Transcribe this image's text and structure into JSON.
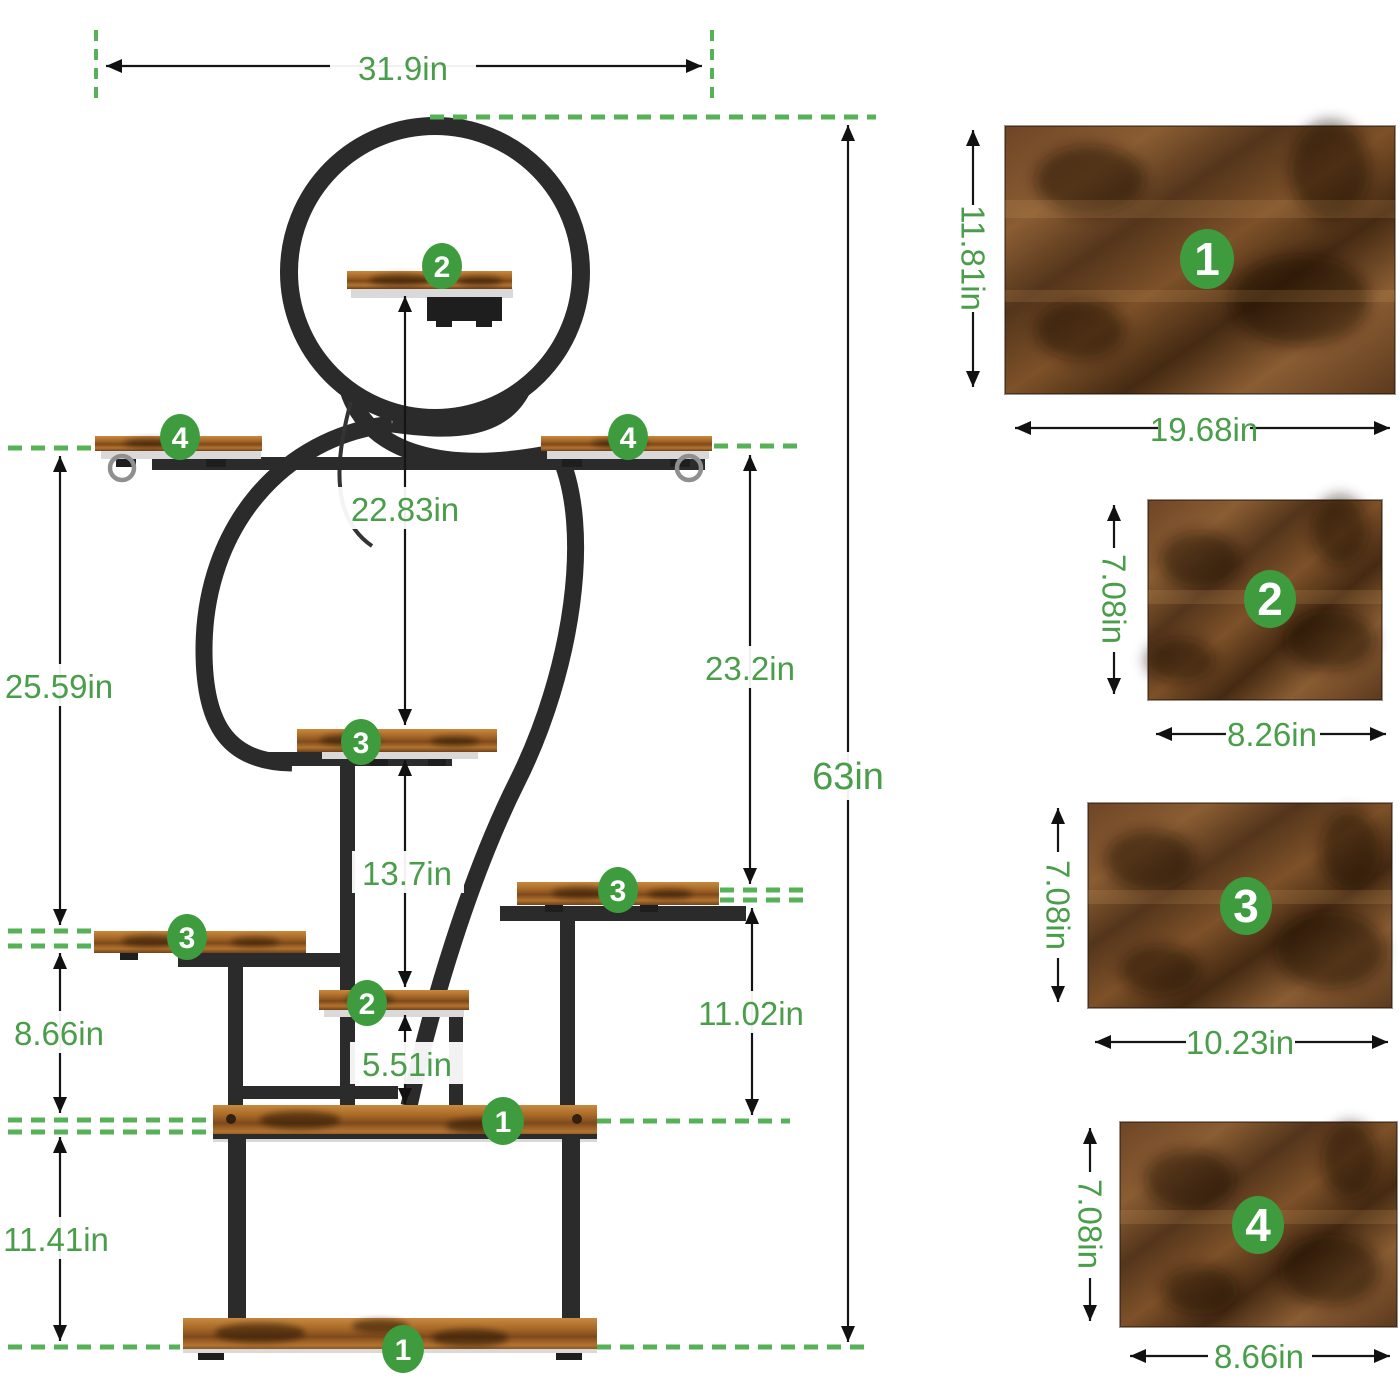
{
  "diagram": {
    "badge_labels": {
      "b1": "1",
      "b2": "2",
      "b3": "3",
      "b4": "4"
    },
    "dims": {
      "top_width": "31.9in",
      "total_height": "63in",
      "shelf2_to_shelf3": "22.83in",
      "arm_to_shelf3_left": "25.59in",
      "arm_to_shelf3_right": "23.2in",
      "shelf3_to_shelf2": "13.7in",
      "shelf3_to_board_left": "8.66in",
      "shelf3_to_board_right": "11.02in",
      "shelf2_to_board": "5.51in",
      "board_to_floor": "11.41in"
    }
  },
  "panels": [
    {
      "num": "1",
      "width": "19.68in",
      "height": "11.81in"
    },
    {
      "num": "2",
      "width": "8.26in",
      "height": "7.08in"
    },
    {
      "num": "3",
      "width": "10.23in",
      "height": "7.08in"
    },
    {
      "num": "4",
      "width": "8.66in",
      "height": "7.08in"
    }
  ],
  "colors": {
    "accent_green": "#4a9d4a",
    "badge_green": "#3e9c3e",
    "dash_green": "#57b157",
    "frame_black": "#2b2b2b",
    "wood_brown": "#8a5527",
    "lip_silver": "#d9d9d9"
  }
}
